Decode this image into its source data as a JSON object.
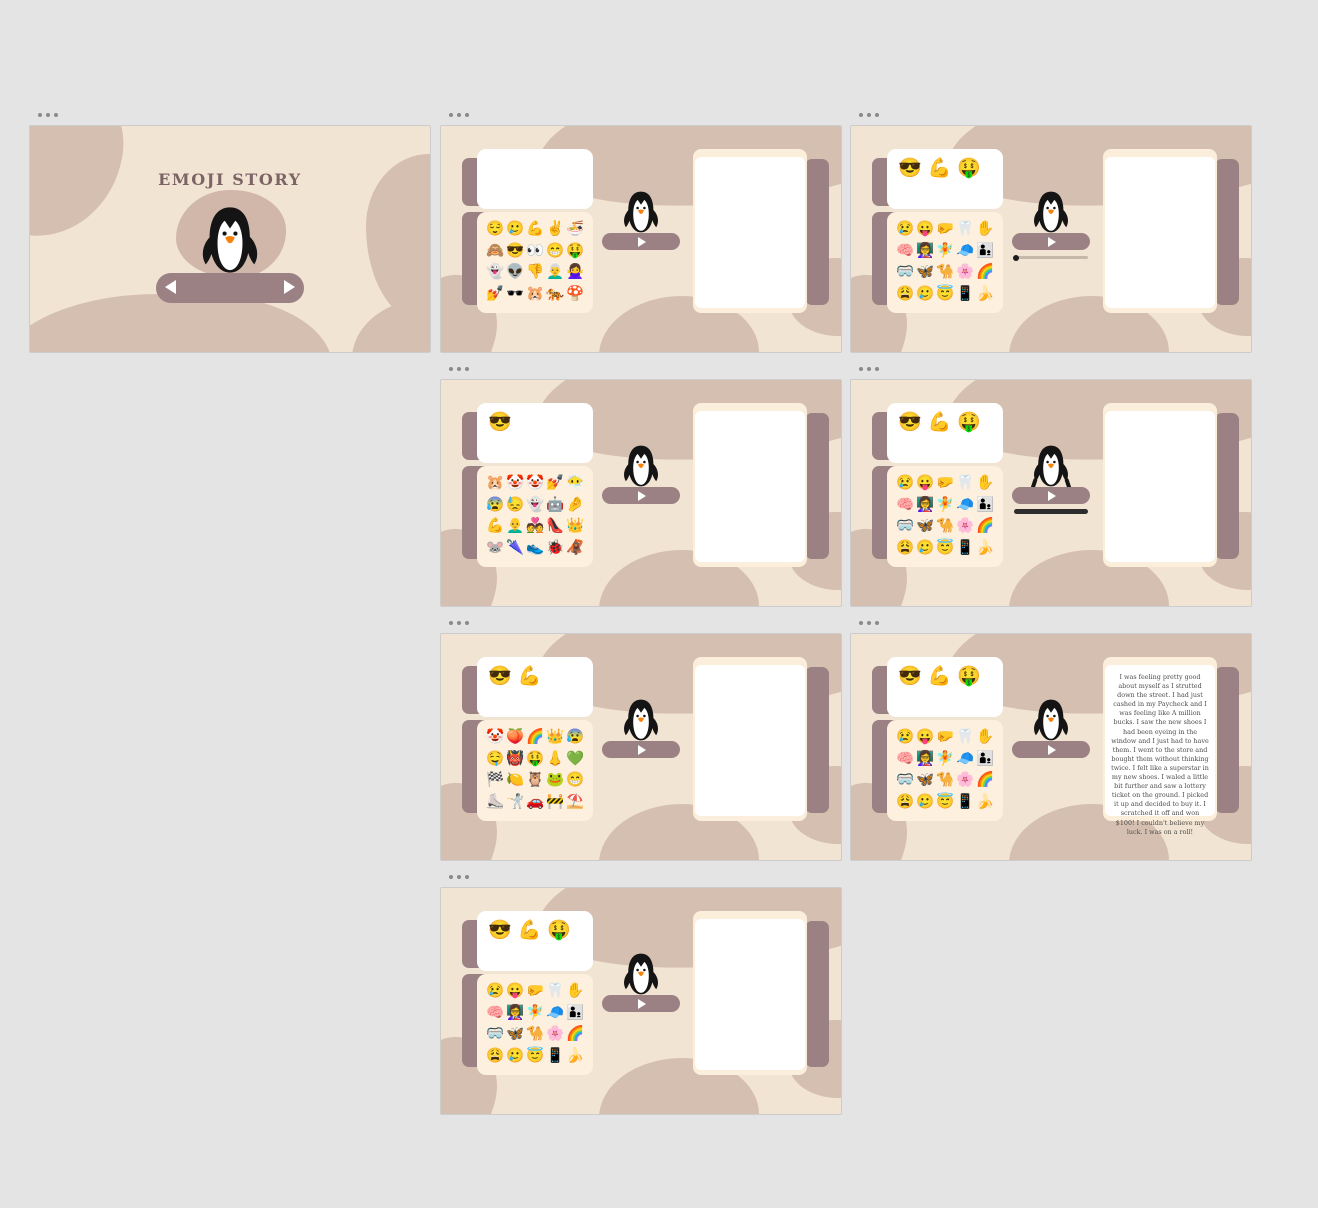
{
  "app": {
    "background": "#e4e4e4"
  },
  "colors": {
    "slide_bg": "#f2e4d2",
    "blob": "#d5bfb0",
    "accent_mauve": "#9b8183",
    "panel_cream": "#fdf0df",
    "right_card_cream": "#fbeedb",
    "card_white": "#ffffff",
    "title_text": "#7c6466",
    "story_text": "#4e4e4e",
    "progress_track": "#c6b8a8",
    "progress_dark": "#2d2d2d",
    "penguin_black": "#141414",
    "penguin_beak_orange": "#f6820c"
  },
  "icons": {
    "slide_menu": "•••",
    "play": "▶",
    "prev": "◀",
    "next": "▶"
  },
  "slides": {
    "s1": {
      "title": "EMOJI STORY"
    },
    "s2": {
      "header_emojis": [],
      "grid": [
        "😌",
        "🥲",
        "💪",
        "✌️",
        "🍜",
        "🙈",
        "😎",
        "👀",
        "😁",
        "🤑",
        "👻",
        "👽",
        "👎",
        "👨‍🦳",
        "🙅‍♀️",
        "💅",
        "🕶️",
        "🐹",
        "🐅",
        "🍄"
      ]
    },
    "s3": {
      "header_emojis": [
        "😎",
        "💪",
        "🤑"
      ],
      "grid": [
        "😢",
        "😛",
        "🤛",
        "🦷",
        "✋",
        "🧠",
        "👩‍🏫",
        "🧚",
        "🧢",
        "👨‍👦",
        "🥽",
        "🦋",
        "🐪",
        "🌸",
        "🌈",
        "😩",
        "🥲",
        "😇",
        "📱",
        "🍌"
      ]
    },
    "s4": {
      "header_emojis": [
        "😎"
      ],
      "grid": [
        "🐹",
        "🤡",
        "🤡",
        "💅",
        "😶‍🌫️",
        "😰",
        "😓",
        "👻",
        "🤖",
        "🤌",
        "💪",
        "👨‍🦲",
        "💑",
        "👠",
        "👑",
        "🐭",
        "🌂",
        "👟",
        "🐞",
        "🦧"
      ]
    },
    "s5": {
      "header_emojis": [
        "😎",
        "💪",
        "🤑"
      ],
      "grid": [
        "😢",
        "😛",
        "🤛",
        "🦷",
        "✋",
        "🧠",
        "👩‍🏫",
        "🧚",
        "🧢",
        "👨‍👦",
        "🥽",
        "🦋",
        "🐪",
        "🌸",
        "🌈",
        "😩",
        "🥲",
        "😇",
        "📱",
        "🍌"
      ]
    },
    "s6": {
      "header_emojis": [
        "😎",
        "💪"
      ],
      "grid": [
        "🤡",
        "🍑",
        "🌈",
        "👑",
        "😰",
        "🤤",
        "👹",
        "🤑",
        "👃",
        "💚",
        "🏁",
        "🍋",
        "🦉",
        "🐸",
        "😁",
        "⛸️",
        "🤺",
        "🚗",
        "🚧",
        "⛱️"
      ]
    },
    "s7": {
      "header_emojis": [
        "😎",
        "💪",
        "🤑"
      ],
      "grid": [
        "😢",
        "😛",
        "🤛",
        "🦷",
        "✋",
        "🧠",
        "👩‍🏫",
        "🧚",
        "🧢",
        "👨‍👦",
        "🥽",
        "🦋",
        "🐪",
        "🌸",
        "🌈",
        "😩",
        "🥲",
        "😇",
        "📱",
        "🍌"
      ],
      "story": "I was feeling pretty good about myself as I strutted down the street. I had just cashed in my Paycheck and I was feeling like A million bucks. I saw the new shoes I had been eyeing in the window and I just had to have them. I went to the store and bought them without thinking twice. I felt like a superstar in my new shoes. I waled a little bit further and saw a lottery ticket on the ground. I picked it up and decided to buy it. I scratched it off and won $100! I couldn't believe my luck. I was on a roll!"
    },
    "s8": {
      "header_emojis": [
        "😎",
        "💪",
        "🤑"
      ],
      "grid": [
        "😢",
        "😛",
        "🤛",
        "🦷",
        "✋",
        "🧠",
        "👩‍🏫",
        "🧚",
        "🧢",
        "👨‍👦",
        "🥽",
        "🦋",
        "🐪",
        "🌸",
        "🌈",
        "😩",
        "🥲",
        "😇",
        "📱",
        "🍌"
      ]
    }
  }
}
